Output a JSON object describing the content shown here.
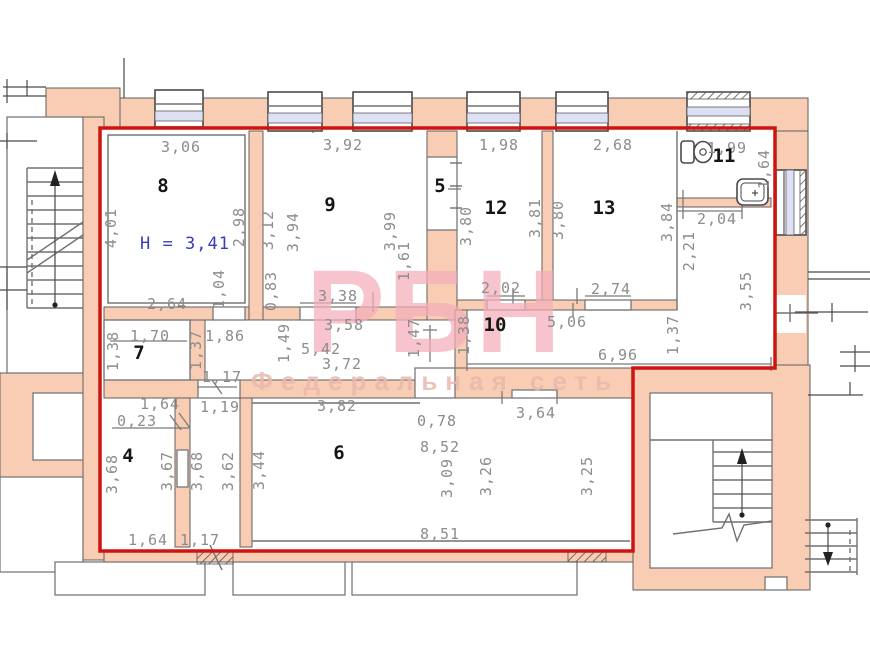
{
  "watermark": {
    "brand": "РБН",
    "subtitle": "Федеральная сеть"
  },
  "plan": {
    "height_note": "H = 3,41",
    "rooms": {
      "r4": {
        "number": "4",
        "top_width": "1,64",
        "top_offset": "0,23",
        "left_height": "3,68",
        "right_height": "3,67",
        "bottom_width": "1,64"
      },
      "r5": {
        "number": "5"
      },
      "r6": {
        "number": "6",
        "top_width": "3,82",
        "left_height": "3,44",
        "top_small": "0,78",
        "inner_width": "8,52",
        "inner_height_1": "3,09",
        "inner_height_2": "3,26",
        "inner_height_3": "3,25",
        "top_opening": "3,64",
        "bottom_width": "8,51"
      },
      "r7": {
        "number": "7",
        "top_width": "1,70",
        "left_height": "1,38",
        "right_height": "1,37",
        "door_width": "1,86",
        "bottom_door": "1,17"
      },
      "r8": {
        "number": "8",
        "top_width": "3,06",
        "left_height": "4,01",
        "right_height": "2,98",
        "bottom_width": "2,64",
        "shaft_height": "1,04"
      },
      "r9": {
        "number": "9",
        "top_width": "3,92",
        "left_height_1": "3,12",
        "left_height_2": "3,94",
        "right_height_1": "3,99",
        "right_height_2": "1,61",
        "left_lower": "0,83",
        "bottom_opening": "3,38"
      },
      "r10": {
        "number": "10",
        "door_1": "2,02",
        "door_2": "2,74",
        "width": "5,06",
        "left_height": "1,38",
        "bottom_width": "6,96"
      },
      "r11": {
        "number": "11",
        "top_width": "1,99",
        "right_height": "1,64",
        "bottom_width": "2,04"
      },
      "r12": {
        "number": "12",
        "top_width": "1,98",
        "left_height": "3,80",
        "right_height": "3,81"
      },
      "r13": {
        "number": "13",
        "top_width": "2,68",
        "left_height": "3,80",
        "right_height": "3,84"
      },
      "hall": {
        "width_1": "3,58",
        "width_2": "5,42",
        "width_3": "3,72",
        "left_height": "1,49",
        "right_height": "1,47",
        "door": "1,17"
      },
      "right_section": {
        "height_1": "2,21",
        "height_2": "3,55",
        "height_3": "1,37"
      },
      "corridor": {
        "top_width": "1,19",
        "left_height": "3,68",
        "right_height": "3,62",
        "bottom_width": "1,17"
      }
    }
  }
}
